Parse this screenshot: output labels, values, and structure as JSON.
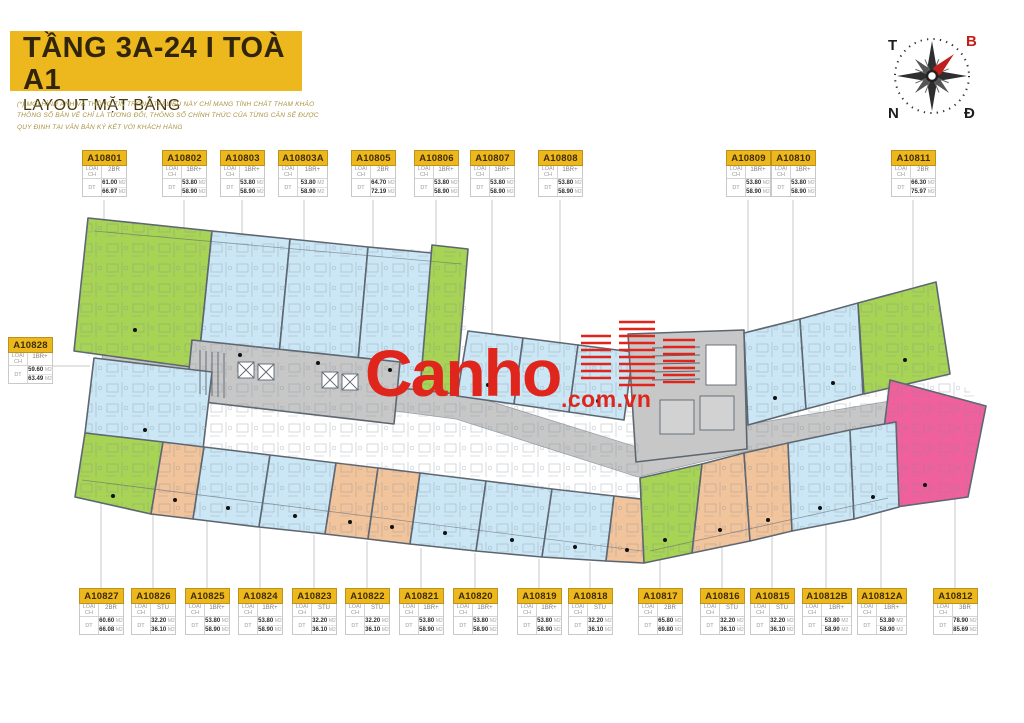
{
  "header": {
    "title": "TẦNG 3A-24 I TOÀ A1",
    "subtitle": "LAYOUT MẶT BẰNG",
    "disclaimer_lines": [
      "(*) MỌI HÌNH ẢNH VÀ THÔNG TIN TRONG TÀI LIỆU NÀY CHỈ MANG TÍNH CHẤT THAM KHẢO",
      "THÔNG SỐ BẢN VẼ CHỈ LÀ TƯƠNG ĐỐI, THÔNG SỐ CHÍNH THỨC CỦA TỪNG CĂN SẼ ĐƯỢC",
      "QUY ĐỊNH TẠI VĂN BẢN KÝ KẾT VỚI KHÁCH HÀNG"
    ]
  },
  "compass": {
    "west": "T",
    "north": "B",
    "south": "N",
    "east": "Đ"
  },
  "logo": {
    "word": "Canho",
    "suffix": ".com.vn"
  },
  "fields": {
    "type": "LOẠI CH",
    "area": "DT",
    "unit": "M2"
  },
  "palette": {
    "yellow": "#edb71e",
    "green": "#a7d455",
    "blue": "#cbe7f5",
    "orange": "#f2c49c",
    "pink": "#f0609c",
    "gray": "#c7c7c7",
    "wall": "#5d6670",
    "red": "#e0251c",
    "leader": "#c9c9c9",
    "compass_north": "#c0201a"
  },
  "units": {
    "top": [
      {
        "id": "A10801",
        "type": "2BR",
        "a1": "61.00",
        "a2": "66.97",
        "x": 82,
        "y": 150
      },
      {
        "id": "A10802",
        "type": "1BR+",
        "a1": "53.80",
        "a2": "58.90",
        "x": 162,
        "y": 150
      },
      {
        "id": "A10803",
        "type": "1BR+",
        "a1": "53.80",
        "a2": "58.90",
        "x": 220,
        "y": 150
      },
      {
        "id": "A10803A",
        "type": "1BR+",
        "a1": "53.80",
        "a2": "58.90",
        "x": 278,
        "y": 150
      },
      {
        "id": "A10805",
        "type": "2BR",
        "a1": "64.70",
        "a2": "72.19",
        "x": 351,
        "y": 150
      },
      {
        "id": "A10806",
        "type": "1BR+",
        "a1": "53.80",
        "a2": "58.90",
        "x": 414,
        "y": 150
      },
      {
        "id": "A10807",
        "type": "1BR+",
        "a1": "53.80",
        "a2": "58.90",
        "x": 470,
        "y": 150
      },
      {
        "id": "A10808",
        "type": "1BR+",
        "a1": "53.80",
        "a2": "58.90",
        "x": 538,
        "y": 150
      },
      {
        "id": "A10809",
        "type": "1BR+",
        "a1": "53.80",
        "a2": "58.90",
        "x": 726,
        "y": 150
      },
      {
        "id": "A10810",
        "type": "1BR+",
        "a1": "53.80",
        "a2": "58.90",
        "x": 771,
        "y": 150
      },
      {
        "id": "A10811",
        "type": "2BR",
        "a1": "66.30",
        "a2": "75.97",
        "x": 891,
        "y": 150
      }
    ],
    "left": [
      {
        "id": "A10828",
        "type": "1BR+",
        "a1": "59.60",
        "a2": "63.49",
        "x": 8,
        "y": 337
      }
    ],
    "bottom": [
      {
        "id": "A10827",
        "type": "2BR",
        "a1": "60.60",
        "a2": "66.08",
        "x": 79,
        "y": 588
      },
      {
        "id": "A10826",
        "type": "STU",
        "a1": "32.20",
        "a2": "36.10",
        "x": 131,
        "y": 588
      },
      {
        "id": "A10825",
        "type": "1BR+",
        "a1": "53.80",
        "a2": "58.90",
        "x": 185,
        "y": 588
      },
      {
        "id": "A10824",
        "type": "1BR+",
        "a1": "53.80",
        "a2": "58.90",
        "x": 238,
        "y": 588
      },
      {
        "id": "A10823",
        "type": "STU",
        "a1": "32.20",
        "a2": "36.10",
        "x": 292,
        "y": 588
      },
      {
        "id": "A10822",
        "type": "STU",
        "a1": "32.20",
        "a2": "36.10",
        "x": 345,
        "y": 588
      },
      {
        "id": "A10821",
        "type": "1BR+",
        "a1": "53.80",
        "a2": "58.90",
        "x": 399,
        "y": 588
      },
      {
        "id": "A10820",
        "type": "1BR+",
        "a1": "53.80",
        "a2": "58.90",
        "x": 453,
        "y": 588
      },
      {
        "id": "A10819",
        "type": "1BR+",
        "a1": "53.80",
        "a2": "58.90",
        "x": 517,
        "y": 588
      },
      {
        "id": "A10818",
        "type": "STU",
        "a1": "32.20",
        "a2": "36.10",
        "x": 568,
        "y": 588
      },
      {
        "id": "A10817",
        "type": "2BR",
        "a1": "65.80",
        "a2": "69.80",
        "x": 638,
        "y": 588
      },
      {
        "id": "A10816",
        "type": "STU",
        "a1": "32.20",
        "a2": "36.10",
        "x": 700,
        "y": 588
      },
      {
        "id": "A10815",
        "type": "STU",
        "a1": "32.20",
        "a2": "36.10",
        "x": 750,
        "y": 588
      },
      {
        "id": "A10812B",
        "type": "1BR+",
        "a1": "53.80",
        "a2": "58.90",
        "x": 802,
        "y": 588
      },
      {
        "id": "A10812A",
        "type": "1BR+",
        "a1": "53.80",
        "a2": "58.90",
        "x": 857,
        "y": 588
      },
      {
        "id": "A10812",
        "type": "3BR",
        "a1": "78.90",
        "a2": "85.69",
        "x": 933,
        "y": 588
      }
    ]
  }
}
